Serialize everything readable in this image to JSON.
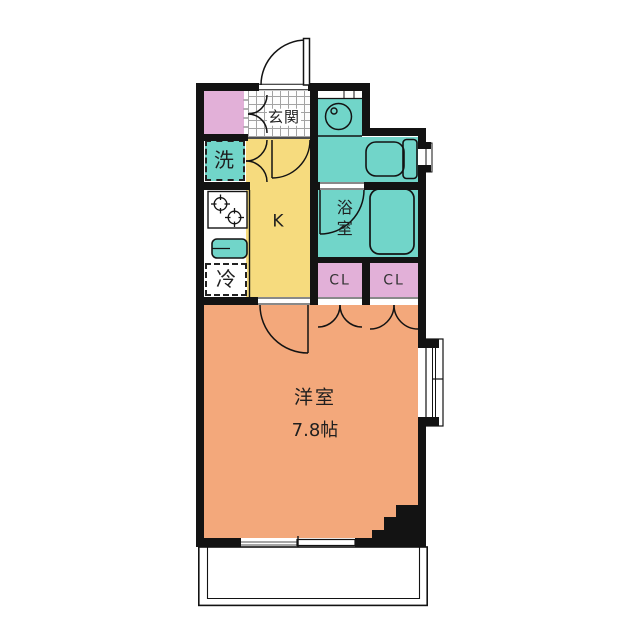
{
  "plan": {
    "type_note": "apartment-floor-plan",
    "rooms": {
      "entrance": {
        "label": "玄関"
      },
      "entrance_closet": {
        "label": ""
      },
      "washer": {
        "label": "洗"
      },
      "kitchen": {
        "label": "K"
      },
      "fridge": {
        "label": "冷"
      },
      "bathroom": {
        "label": "浴室"
      },
      "toilet": {
        "label": ""
      },
      "closet_left": {
        "label": "CL"
      },
      "closet_right": {
        "label": "CL"
      },
      "main_room": {
        "label": "洋室",
        "size": "7.8帖"
      }
    },
    "colors": {
      "wall": "#131313",
      "wet_area_teal": "#71d5c9",
      "closet_pink": "#e2b0d8",
      "kitchen_yellow": "#f6db7e",
      "main_room_orange": "#f3a87b",
      "background": "#ffffff"
    }
  }
}
